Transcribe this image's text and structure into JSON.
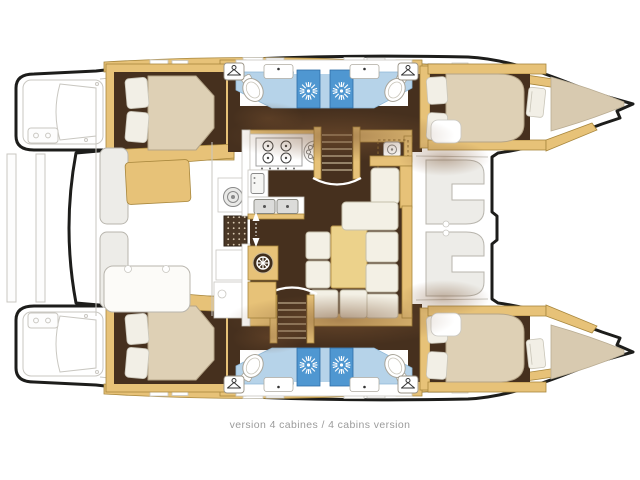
{
  "caption": {
    "text": "version 4 cabines / 4 cabins version"
  },
  "palette": {
    "outline": "#1d1d1b",
    "deckline": "#c9c7c1",
    "wood": "#e7c278",
    "wooddark": "#a8873d",
    "floor": "#46301e",
    "bed": "#ded0b5",
    "bedline": "#b4a487",
    "pillow": "#f2efe6",
    "bath": "#b6d3e9",
    "shower": "#4f97d1",
    "showerline": "#2d6da6",
    "cushion": "#f3f0e5",
    "cushionline": "#c6c0ac",
    "tablewood": "#ecd28b",
    "forepeak": "#d8cab0",
    "gray": "#b8b5ad",
    "grayfill": "#edece8",
    "grate": "#4a3726",
    "gratedot": "#d6c6ae",
    "steel": "#dcdcda",
    "shadow": "#7a5230",
    "caption": "#9b9b9b"
  },
  "icons": [
    "hanger-icon",
    "shower-drain-icon",
    "toilet-icon",
    "sink-icon",
    "stove-burner-icon",
    "round-burner-icon",
    "fridge-icon",
    "double-sink-icon",
    "winch-icon",
    "deck-grate-icon",
    "ships-wheel-icon",
    "door-slide-arrow-icon",
    "cup-holder-icon",
    "hatch-icon"
  ]
}
